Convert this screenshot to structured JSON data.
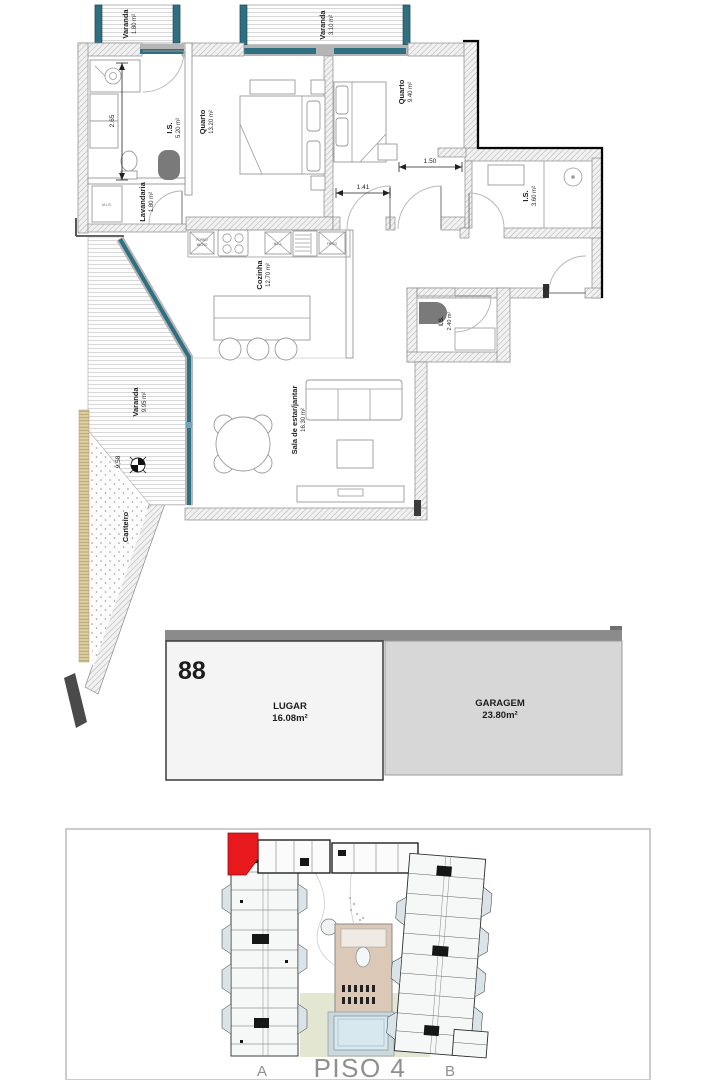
{
  "plan": {
    "balconies": [
      {
        "name": "Varanda",
        "area": "1.80 m²"
      },
      {
        "name": "Varanda",
        "area": "3.10 m²"
      },
      {
        "name": "Varanda",
        "area": "9.95 m²"
      }
    ],
    "rooms": [
      {
        "name": "I.S.",
        "area": "5.20 m²"
      },
      {
        "name": "Quarto",
        "area": "13.20 m²"
      },
      {
        "name": "Quarto",
        "area": "9.40 m²"
      },
      {
        "name": "Lavandaria",
        "area": "1.80 m²"
      },
      {
        "name": "I.S.",
        "area": "3.60 m²"
      },
      {
        "name": "Cozinha",
        "area": "12.70 m²"
      },
      {
        "name": "I.S.",
        "area": "2.40 m²"
      },
      {
        "name": "Sala de estar/jantar",
        "area": "16.30 m²"
      },
      {
        "name": "Canteiro",
        "area": ""
      }
    ],
    "dimensions": {
      "bath_height": "2.65",
      "hall_width_a": "1.41",
      "hall_width_b": "1.50",
      "balcony_length": "9,58"
    },
    "appliances": {
      "oven": "FORNO",
      "micro": "MICRO",
      "dishwasher": "M.L.L.",
      "fridge": "FRIGO",
      "washer": "M.L.R."
    }
  },
  "garage": {
    "unit_number": "88",
    "spot_label": "LUGAR",
    "spot_area": "16.08m²",
    "garage_label": "GARAGEM",
    "garage_area": "23.80m²"
  },
  "site": {
    "wing_a_label": "A",
    "floor_label": "PISO 4",
    "wing_b_label": "B"
  },
  "colors": {
    "glazing_teal": "#2e6f82",
    "highlight_red": "#e8191d",
    "garage_dark": "#8b8b8b",
    "lawn_green": "#e3e6d0",
    "building_tan": "#dbc8b6",
    "pool_blue": "#d8e8ef"
  }
}
